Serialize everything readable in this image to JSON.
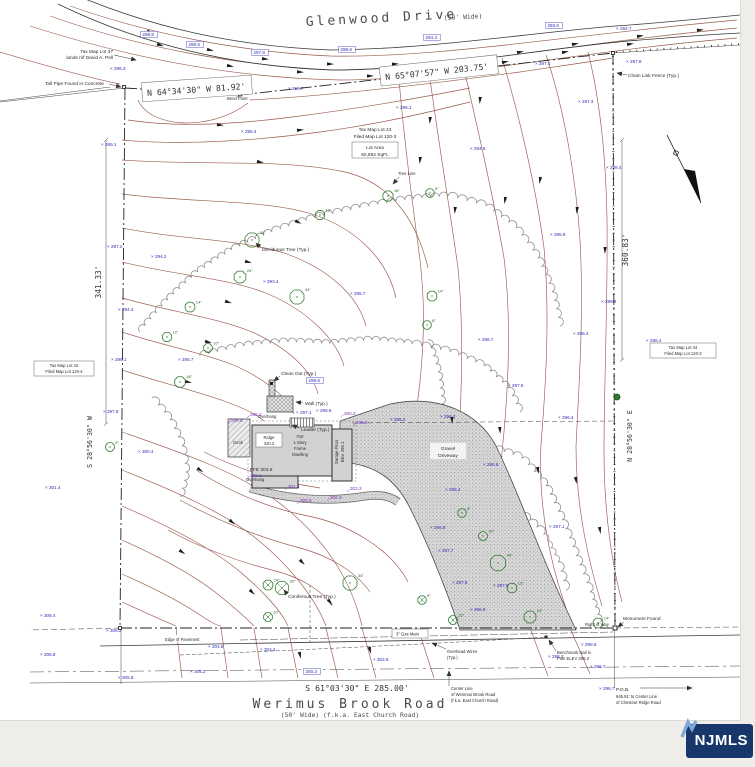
{
  "watermark": {
    "label": "NJMLS"
  },
  "roads": {
    "top_name": "Glenwood Drive",
    "top_note": "(50' Wide)",
    "bottom_name": "Werimus Brook Road",
    "bottom_note": "(50' Wide)  (f.k.a. East Church Road)"
  },
  "bearings": {
    "top_left": "N 64°34'30\" W   81.92'",
    "top_right": "N 65°07'57\" W   203.75'",
    "left": "S 28°56'30\" W",
    "left_dist": "341.33'",
    "right": "N 28°56'30\" E",
    "right_dist": "360.83'",
    "bottom": "S 61°03'30\" E    285.00'"
  },
  "parcels": {
    "lot37_1": "Tax Map Lot 37",
    "lot37_2": "lands n/f David A. Pell",
    "lot42_1": "Tax Map Lot 42",
    "lot42_2": "Filed Map Lot 120-4",
    "lot43_1": "Tax Map Lot 43",
    "lot43_2": "Filed Map Lot 120-3",
    "lot43_area_1": "Lot Area",
    "lot43_area_2": "92,852 SqFt.",
    "lot44_1": "Tax Map Lot 44",
    "lot44_2": "Filed Map Lot 120-2"
  },
  "house": {
    "no": "#10",
    "l1": "1 Story",
    "l2": "Frame",
    "l3": "Dwelling",
    "ridge1": "Ridge",
    "ridge2": "320.2",
    "ffe": "FFE 303.8",
    "garage1": "Garage Floor",
    "garage2": "Elev. 295.1",
    "deck": "Deck",
    "gravel1": "Gravel",
    "gravel2": "Driveway"
  },
  "notes": {
    "pipe": "Tall Pipe Found in Concrete",
    "bend": "Bend Point",
    "chain": "Chain Link Fence (Typ.)",
    "tree_line": "Tree Line",
    "deciduous": "Deciduous Tree (Typ.)",
    "coniferous": "Coniferous Tree (Typ.)",
    "clean_out": "Clean Out (Typ.)",
    "wall": "Wall (Typ.)",
    "overhang": "Overhang",
    "leader": "Leader (Typ.)",
    "gas": "3\" Gas Main",
    "edge_pav": "Edge of Pavement",
    "wires1": "Overhead Wires",
    "wires2": "(Typ.)",
    "bench1": "Benchmark Nail in",
    "bench2": "Pole ELEV 305.3",
    "monument": "Monument Found",
    "row": "Right of Way",
    "cl1": "Center Line",
    "cl2": "of Werimus Brook Road",
    "cl3": "(f.k.a. East Church Road)",
    "pob1": "P.O.B.",
    "pob2": "645.91' to Center Line",
    "pob3": "of Chestnut Ridge Road"
  },
  "colors": {
    "contour": "#9a5a4d",
    "spot": "#2d2db5",
    "grade": "#7b2fbe",
    "tree": "#2f7a2f",
    "treeline": "#8f8f8f",
    "badge_bg": "#17376b",
    "badge_arrow": "#7fa8d9"
  },
  "spot_elevations": [
    {
      "x": 142,
      "y": 36,
      "v": "298.8",
      "box": true
    },
    {
      "x": 188,
      "y": 46,
      "v": "298.6",
      "box": true
    },
    {
      "x": 253,
      "y": 54,
      "v": "297.8",
      "box": true
    },
    {
      "x": 340,
      "y": 51,
      "v": "298.6",
      "box": true
    },
    {
      "x": 425,
      "y": 39,
      "v": "294.3",
      "box": true
    },
    {
      "x": 547,
      "y": 27,
      "v": "293.6",
      "box": true
    },
    {
      "x": 616,
      "y": 30,
      "v": "294.7"
    },
    {
      "x": 110,
      "y": 70,
      "v": "296.3"
    },
    {
      "x": 288,
      "y": 90,
      "v": "296.7"
    },
    {
      "x": 535,
      "y": 65,
      "v": "297.1"
    },
    {
      "x": 626,
      "y": 63,
      "v": "297.8"
    },
    {
      "x": 396,
      "y": 109,
      "v": "296.1"
    },
    {
      "x": 578,
      "y": 103,
      "v": "297.3"
    },
    {
      "x": 241,
      "y": 133,
      "v": "295.4"
    },
    {
      "x": 101,
      "y": 146,
      "v": "299.1"
    },
    {
      "x": 470,
      "y": 150,
      "v": "294.6"
    },
    {
      "x": 107,
      "y": 248,
      "v": "297.2"
    },
    {
      "x": 151,
      "y": 258,
      "v": "294.2"
    },
    {
      "x": 263,
      "y": 283,
      "v": "293.4"
    },
    {
      "x": 350,
      "y": 295,
      "v": "295.7"
    },
    {
      "x": 118,
      "y": 311,
      "v": "294.4"
    },
    {
      "x": 111,
      "y": 361,
      "v": "295.1"
    },
    {
      "x": 178,
      "y": 361,
      "v": "295.7"
    },
    {
      "x": 103,
      "y": 413,
      "v": "297.8"
    },
    {
      "x": 308,
      "y": 382,
      "v": "298.8",
      "box": true
    },
    {
      "x": 138,
      "y": 453,
      "v": "300.4"
    },
    {
      "x": 45,
      "y": 489,
      "v": "301.4"
    },
    {
      "x": 478,
      "y": 341,
      "v": "296.7"
    },
    {
      "x": 573,
      "y": 335,
      "v": "296.4"
    },
    {
      "x": 508,
      "y": 387,
      "v": "297.8"
    },
    {
      "x": 601,
      "y": 303,
      "v": "299.4"
    },
    {
      "x": 646,
      "y": 342,
      "v": "296.4"
    },
    {
      "x": 606,
      "y": 169,
      "v": "298.4"
    },
    {
      "x": 550,
      "y": 236,
      "v": "295.9"
    },
    {
      "x": 483,
      "y": 466,
      "v": "296.8"
    },
    {
      "x": 445,
      "y": 491,
      "v": "296.4"
    },
    {
      "x": 430,
      "y": 529,
      "v": "296.8"
    },
    {
      "x": 549,
      "y": 528,
      "v": "297.1"
    },
    {
      "x": 493,
      "y": 587,
      "v": "297.8"
    },
    {
      "x": 390,
      "y": 421,
      "v": "295.2"
    },
    {
      "x": 440,
      "y": 418,
      "v": "296.2"
    },
    {
      "x": 558,
      "y": 419,
      "v": "296.4"
    },
    {
      "x": 296,
      "y": 414,
      "v": "297.1"
    },
    {
      "x": 316,
      "y": 412,
      "v": "296.8"
    },
    {
      "x": 438,
      "y": 552,
      "v": "297.7"
    },
    {
      "x": 452,
      "y": 584,
      "v": "297.8"
    },
    {
      "x": 470,
      "y": 611,
      "v": "296.8"
    },
    {
      "x": 40,
      "y": 617,
      "v": "306.4"
    },
    {
      "x": 106,
      "y": 632,
      "v": "306.2"
    },
    {
      "x": 40,
      "y": 656,
      "v": "306.8"
    },
    {
      "x": 118,
      "y": 679,
      "v": "305.8"
    },
    {
      "x": 208,
      "y": 648,
      "v": "304.8"
    },
    {
      "x": 260,
      "y": 651,
      "v": "304.4"
    },
    {
      "x": 305,
      "y": 673,
      "v": "300.3",
      "box": true
    },
    {
      "x": 373,
      "y": 661,
      "v": "302.8"
    },
    {
      "x": 548,
      "y": 658,
      "v": "298.2"
    },
    {
      "x": 581,
      "y": 646,
      "v": "298.6"
    },
    {
      "x": 590,
      "y": 668,
      "v": "296.7"
    },
    {
      "x": 599,
      "y": 690,
      "v": "296.7"
    },
    {
      "x": 190,
      "y": 673,
      "v": "305.2"
    }
  ],
  "grade_spots": [
    {
      "x": 250,
      "y": 416,
      "v": "298.2"
    },
    {
      "x": 231,
      "y": 422,
      "v": "299.8"
    },
    {
      "x": 344,
      "y": 415,
      "v": "300.2"
    },
    {
      "x": 356,
      "y": 424,
      "v": "295.8"
    },
    {
      "x": 250,
      "y": 477,
      "v": "300.1"
    },
    {
      "x": 288,
      "y": 488,
      "v": "301.4"
    },
    {
      "x": 350,
      "y": 490,
      "v": "303.3"
    },
    {
      "x": 300,
      "y": 502,
      "v": "300.8"
    },
    {
      "x": 330,
      "y": 499,
      "v": "302.3"
    }
  ],
  "trees": [
    {
      "x": 252,
      "y": 240,
      "s": "34\"",
      "t": "d"
    },
    {
      "x": 240,
      "y": 277,
      "s": "24\"",
      "t": "d"
    },
    {
      "x": 297,
      "y": 297,
      "s": "34\"",
      "t": "d"
    },
    {
      "x": 320,
      "y": 215,
      "s": "12\"",
      "t": "d"
    },
    {
      "x": 388,
      "y": 196,
      "s": "16\"",
      "t": "d"
    },
    {
      "x": 430,
      "y": 193,
      "s": "8\"",
      "t": "d"
    },
    {
      "x": 432,
      "y": 296,
      "s": "14\"",
      "t": "d"
    },
    {
      "x": 190,
      "y": 307,
      "s": "14\"",
      "t": "d"
    },
    {
      "x": 167,
      "y": 337,
      "s": "12\"",
      "t": "d"
    },
    {
      "x": 208,
      "y": 348,
      "s": "10\"",
      "t": "d"
    },
    {
      "x": 180,
      "y": 382,
      "s": "18\"",
      "t": "d"
    },
    {
      "x": 110,
      "y": 447,
      "s": "9\"",
      "t": "d"
    },
    {
      "x": 462,
      "y": 513,
      "s": "8\"",
      "t": "d"
    },
    {
      "x": 483,
      "y": 536,
      "s": "10\"",
      "t": "d"
    },
    {
      "x": 498,
      "y": 563,
      "s": "40\"",
      "t": "d"
    },
    {
      "x": 512,
      "y": 588,
      "s": "13\"",
      "t": "d"
    },
    {
      "x": 530,
      "y": 617,
      "s": "24\"",
      "t": "d"
    },
    {
      "x": 598,
      "y": 623,
      "s": "14\"",
      "t": "d"
    },
    {
      "x": 427,
      "y": 325,
      "s": "8\"",
      "t": "d"
    },
    {
      "x": 350,
      "y": 583,
      "s": "34\"",
      "t": "d"
    },
    {
      "x": 268,
      "y": 585,
      "s": "14\"",
      "t": "c"
    },
    {
      "x": 282,
      "y": 588,
      "s": "30\"",
      "t": "c"
    },
    {
      "x": 268,
      "y": 617,
      "s": "10\"",
      "t": "c"
    },
    {
      "x": 422,
      "y": 600,
      "s": "8\"",
      "t": "c"
    },
    {
      "x": 453,
      "y": 620,
      "s": "10\"",
      "t": "c"
    }
  ],
  "flow_arrows": [
    [
      150,
      32,
      20
    ],
    [
      210,
      50,
      12
    ],
    [
      265,
      59,
      6
    ],
    [
      330,
      64,
      2
    ],
    [
      395,
      64,
      -4
    ],
    [
      460,
      60,
      -8
    ],
    [
      520,
      52,
      -12
    ],
    [
      575,
      44,
      -10
    ],
    [
      640,
      36,
      -8
    ],
    [
      700,
      30,
      -6
    ],
    [
      160,
      45,
      18
    ],
    [
      230,
      66,
      10
    ],
    [
      300,
      72,
      4
    ],
    [
      370,
      76,
      -2
    ],
    [
      440,
      72,
      -8
    ],
    [
      505,
      62,
      -12
    ],
    [
      565,
      52,
      -10
    ],
    [
      630,
      44,
      -8
    ],
    [
      420,
      160,
      95
    ],
    [
      455,
      210,
      95
    ],
    [
      505,
      200,
      100
    ],
    [
      540,
      180,
      100
    ],
    [
      577,
      210,
      95
    ],
    [
      605,
      250,
      92
    ],
    [
      452,
      420,
      85
    ],
    [
      500,
      430,
      85
    ],
    [
      538,
      470,
      80
    ],
    [
      576,
      480,
      80
    ],
    [
      600,
      530,
      80
    ],
    [
      260,
      162,
      10
    ],
    [
      298,
      222,
      25
    ],
    [
      248,
      262,
      15
    ],
    [
      228,
      302,
      18
    ],
    [
      208,
      342,
      15
    ],
    [
      188,
      382,
      12
    ],
    [
      200,
      470,
      35
    ],
    [
      232,
      522,
      40
    ],
    [
      182,
      552,
      35
    ],
    [
      252,
      592,
      45
    ],
    [
      302,
      562,
      45
    ],
    [
      330,
      602,
      50
    ],
    [
      220,
      125,
      5
    ],
    [
      300,
      130,
      -5
    ],
    [
      370,
      650,
      75
    ],
    [
      300,
      655,
      75
    ],
    [
      480,
      100,
      95
    ],
    [
      430,
      120,
      95
    ]
  ]
}
